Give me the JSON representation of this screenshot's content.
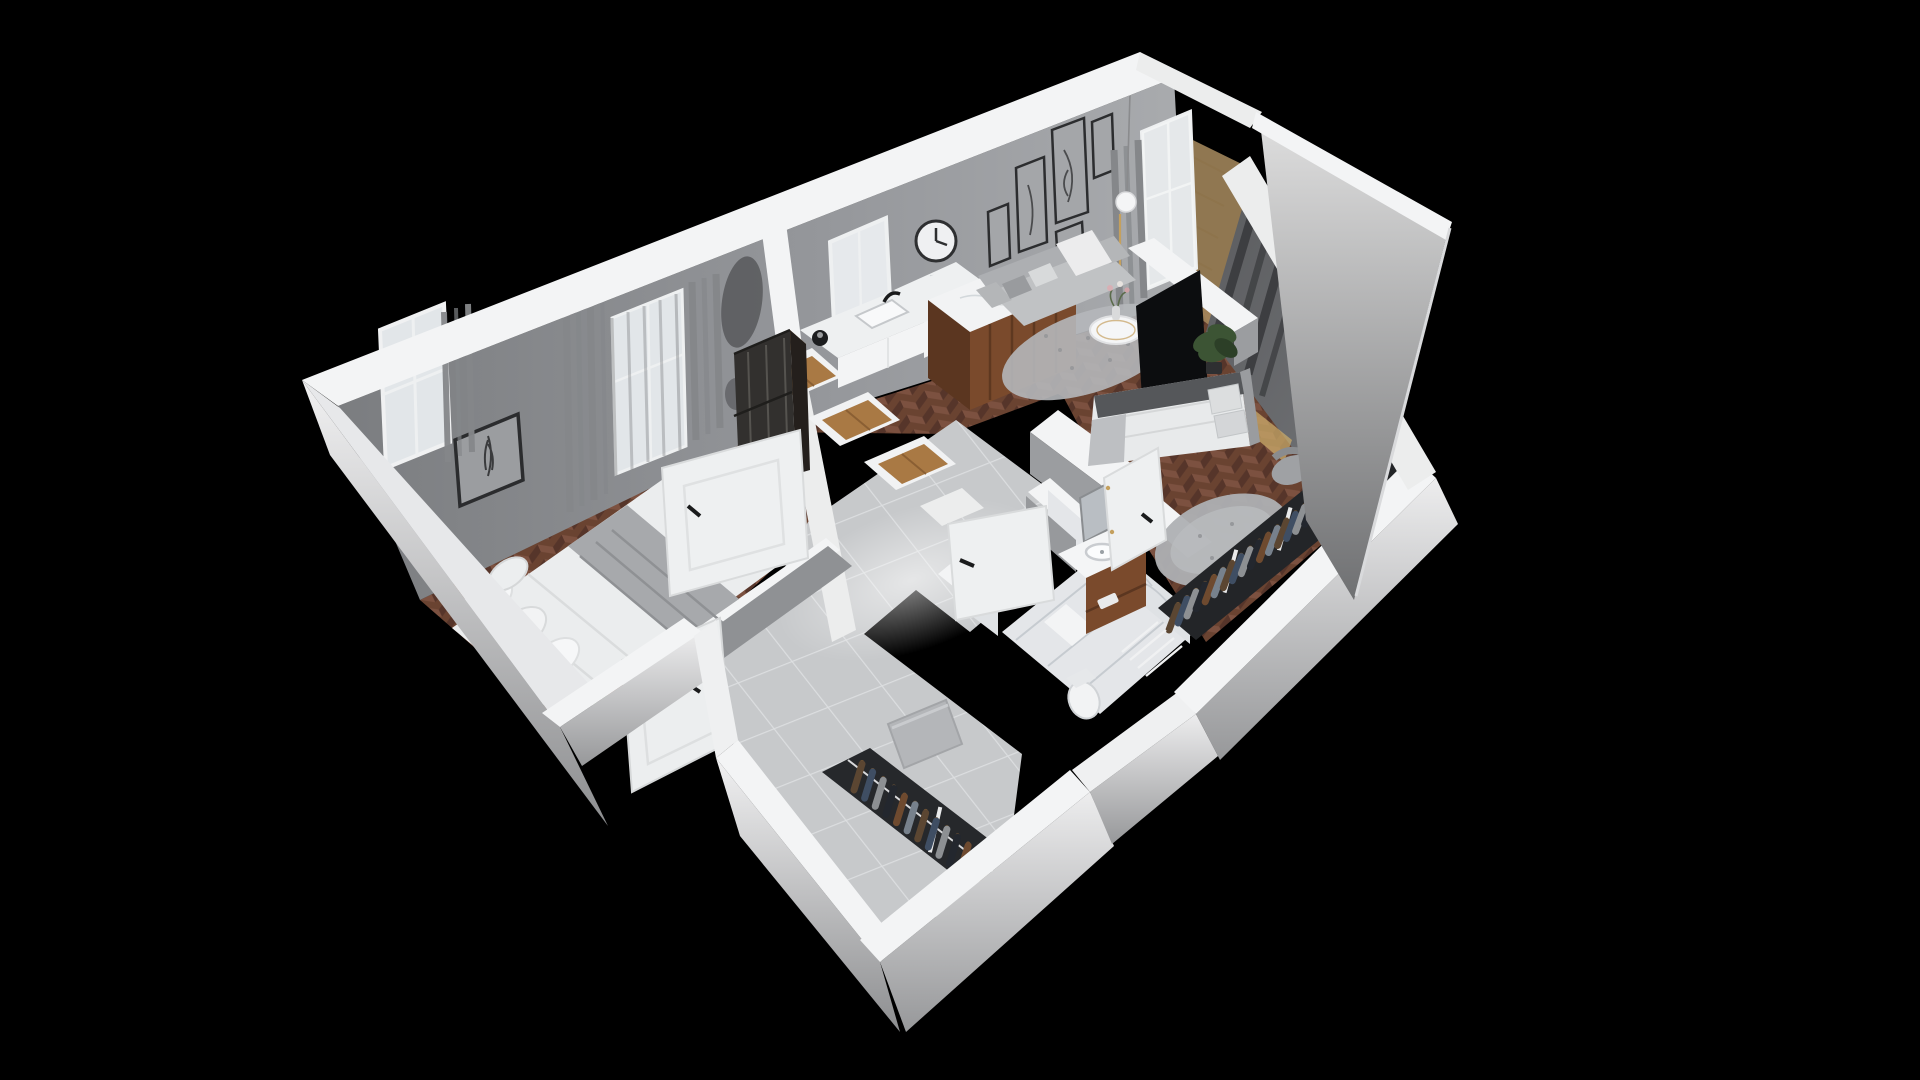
{
  "scene": {
    "background": "#000000",
    "view": "isometric-cutaway-apartment-floorplan",
    "rooms": [
      {
        "name": "bedroom-left",
        "floor": "herringbone-wood",
        "furniture": [
          "double-bed",
          "pillows",
          "gray-blanket",
          "glass-walnut-wardrobe",
          "feather-picture",
          "window-curtains",
          "plant-on-bed"
        ]
      },
      {
        "name": "living-kitchen",
        "floor": "herringbone-wood",
        "furniture": [
          "sofa",
          "coffee-table",
          "vase-flowers",
          "area-rug",
          "wall-clock",
          "gallery-frames",
          "pendant-lamp",
          "kitchen-counter",
          "sink",
          "kettle",
          "island-with-fruit-bowl",
          "tv",
          "balcony-door-curtains"
        ]
      },
      {
        "name": "bedroom-right",
        "floor": "herringbone-wood",
        "furniture": [
          "bed",
          "pillows",
          "dark-curtains",
          "open-wardrobe-with-clothes",
          "round-fluffy-rug",
          "desk",
          "desk-chair",
          "plant"
        ]
      },
      {
        "name": "bathroom",
        "floor": "marble",
        "furniture": [
          "walnut-vanity",
          "basin",
          "mirror",
          "toilet",
          "shower-drain"
        ]
      },
      {
        "name": "hallway-entry",
        "floor": "large-gray-tiles",
        "furniture": [
          "entry-door",
          "coat-rack-with-clothes",
          "bench",
          "tall-closet-boxes"
        ]
      },
      {
        "name": "balcony",
        "floor": "wood"
      }
    ]
  },
  "palette": {
    "bg": "#000000",
    "wallTop": "#f3f4f5",
    "wallTopShade": "#e7e8ea",
    "wallInt1": "#7f8184",
    "wallInt2": "#a8aaad",
    "wallGrayFace": "#8f9194",
    "woodBase": "#6a4331",
    "woodLight": "#7c5140",
    "woodDark": "#56352a",
    "tile": "#c7c9cb",
    "grout": "#dcdee0",
    "marble": "#e4e6e9",
    "vein": "#c6cbd0",
    "curtain": "#85878a",
    "curtainDark": "#3d3e41",
    "glass": "#e2e6e9",
    "walnut": "#7a4a2c",
    "walnutDark": "#5b3620",
    "walnutLight": "#a97944",
    "sofa": "#c0c2c4",
    "sofaDark": "#adafb2",
    "duvet": "#ebedee",
    "blanket": "#a7a9ac",
    "blanketDark": "#55575a",
    "tv": "#0c0d0f",
    "gold": "#c4a05e",
    "plant": "#3c5434",
    "plantDark": "#2c3f27",
    "rug": "#b5b7ba",
    "rug2": "#aeb0b3",
    "doorWhite": "#eef0f1",
    "black": "#1a1b1c",
    "balconyWood": "#a98c5f",
    "closetBg": "#232528",
    "rackBg": "#26282b"
  },
  "clothes": {
    "colors": [
      "#5b4632",
      "#3f4e63",
      "#8d9093",
      "#23272e",
      "#6e4a2f",
      "#77818c"
    ],
    "hanger_color": "#7a5a36",
    "wardrobe_count": 24,
    "hall_count": 14
  }
}
